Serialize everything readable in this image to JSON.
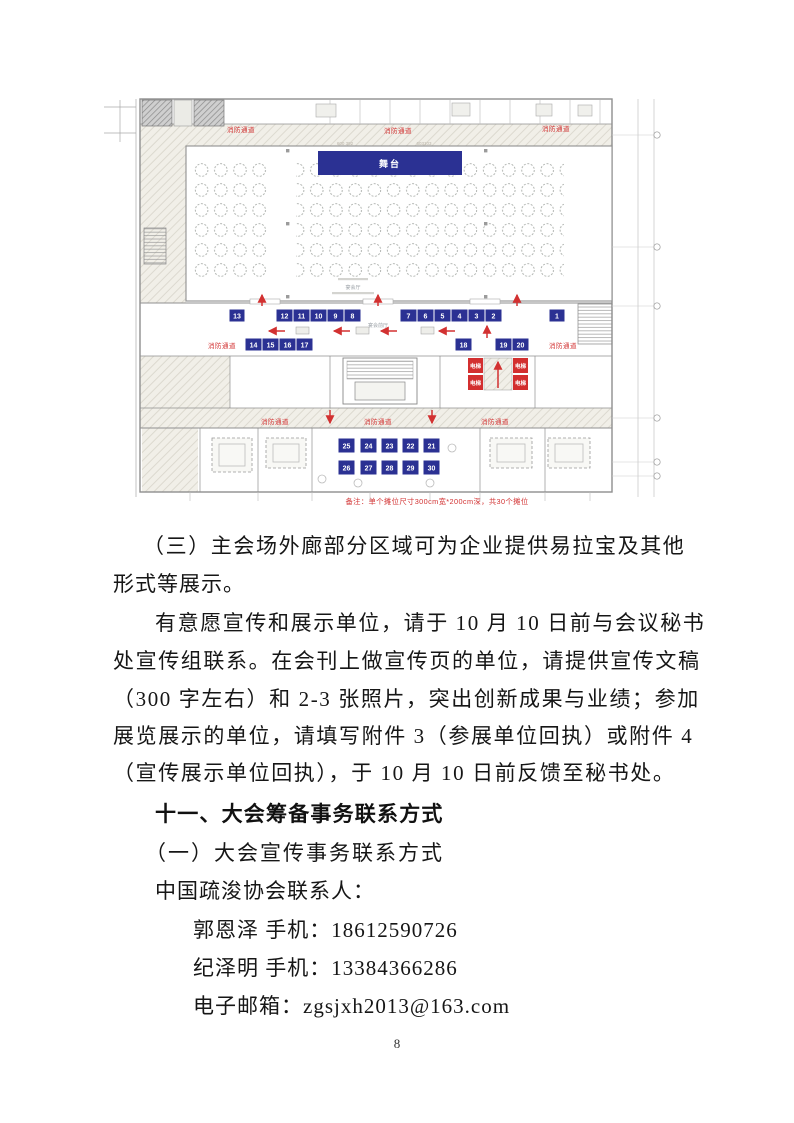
{
  "page_number": "8",
  "floorplan": {
    "stage_label": "舞台",
    "fire_lane_label": "消防通道",
    "elevator_label": "电梯",
    "hall_label": "宴会厅",
    "foyer_label": "宴会前厅",
    "dim_left": "600 392",
    "dim_right": "603103",
    "note": "备注：单个摊位尺寸300cm宽*200cm深，共30个摊位",
    "booths": [
      "1",
      "2",
      "3",
      "4",
      "5",
      "6",
      "7",
      "8",
      "9",
      "10",
      "11",
      "12",
      "13",
      "14",
      "15",
      "16",
      "17",
      "18",
      "19",
      "20",
      "21",
      "22",
      "23",
      "24",
      "25",
      "26",
      "27",
      "28",
      "29",
      "30"
    ]
  },
  "document": {
    "para3_line1": "（三）主会场外廊部分区域可为企业提供易拉宝及其他",
    "para3_line2": "形式等展示。",
    "para4_line1": "有意愿宣传和展示单位，请于 10 月 10 日前与会议秘书",
    "para4_line2": "处宣传组联系。在会刊上做宣传页的单位，请提供宣传文稿",
    "para4_line3": "（300 字左右）和 2-3 张照片，突出创新成果与业绩；参加",
    "para4_line4": "展览展示的单位，请填写附件 3（参展单位回执）或附件 4",
    "para4_line5": "（宣传展示单位回执），于 10 月 10 日前反馈至秘书处。",
    "heading_11": "十一、大会筹备事务联系方式",
    "sub_heading_1": "（一）大会宣传事务联系方式",
    "contact_intro": "中国疏浚协会联系人：",
    "contact_1": "郭恩泽 手机：18612590726",
    "contact_2": "纪泽明 手机：13384366286",
    "contact_email": "电子邮箱：zgsjxh2013@163.com"
  }
}
